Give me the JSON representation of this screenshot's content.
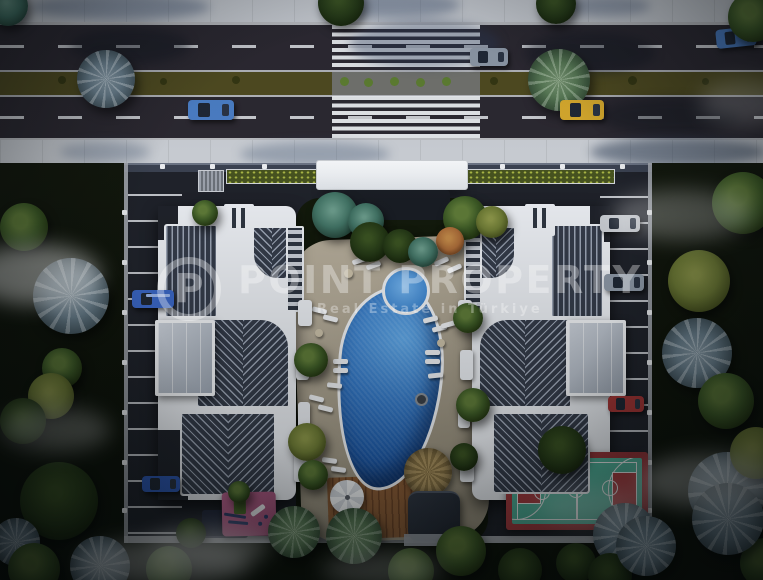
{
  "watermark": {
    "logo_letter": "P",
    "title": "POINT PROPERTY",
    "subtitle": "Real Estate in Türkiye"
  },
  "palette": {
    "asphalt": "#2b2830",
    "sidewalk": "#c7cbd1",
    "lane_line": "#dde0e4",
    "median": "#4e4a20",
    "pavement": "#1f222a",
    "wall_dark": "#3a4150",
    "hedge": "#46521f",
    "building_white": "#e9ecf1",
    "roof_dark": "#343b49",
    "roof_light": "#9aa3b3",
    "glass_light": "#c9cfd8",
    "glass_dark": "#9aa3b0",
    "deck_tan": "#b3aa98",
    "deck_dark": "#968e7c",
    "lounger": "#edeff2",
    "pool_light": "#5ea6e6",
    "pool_mid": "#3478c6",
    "pool_deep": "#1b56a4",
    "spa": "#74b4ee",
    "wood": "#8a5c36",
    "wood_dark": "#6b4326",
    "straw": "#a8905e",
    "straw_dark": "#857044",
    "court_teal": "#4fae97",
    "court_red": "#a63b3f",
    "line_white": "#e9ecec",
    "play_pink": "#bd6490",
    "play_pink2": "#9a4e74",
    "play_navy": "#2a3a66",
    "taxi_yellow": "#d2a62c",
    "car_blue": "#4a7cc2",
    "car_blue_dark": "#2d57b2",
    "van_blue": "#3a66c4",
    "car_silver": "#c6cad0",
    "car_gray": "#8b96a4",
    "car_red": "#a23434",
    "tree_green": "#3d5a26",
    "tree_olive": "#6d7a35",
    "tree_teal": "#417264",
    "tree_orange": "#a86a38",
    "palm_blue": "#6e8492",
    "palm_green": "#597a56"
  }
}
